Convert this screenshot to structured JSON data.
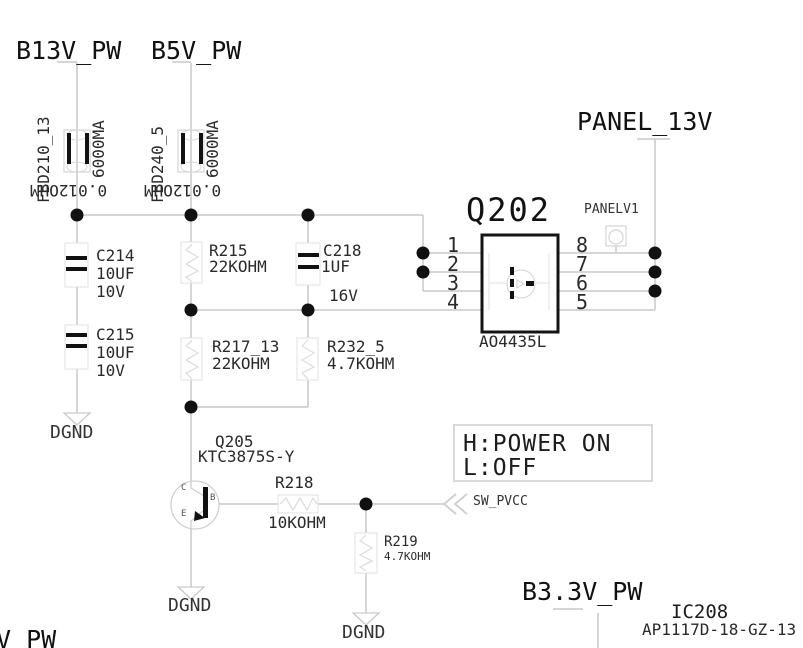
{
  "colors": {
    "wire": "#c9c9c9",
    "outline": "#dcdcdc",
    "ink": "#1a1a1a"
  },
  "power_rails": {
    "b13v": "B13V_PW",
    "b5v": "B5V_PW",
    "panel_13v": "PANEL_13V",
    "b3_3v": "B3.3V_PW",
    "partial_rail": "V_PW"
  },
  "grounds": {
    "dgnd": "DGND"
  },
  "signals": {
    "sw_pvcc": "SW_PVCC"
  },
  "note": {
    "line1": "H:POWER ON",
    "line2": "L:OFF"
  },
  "components": {
    "fbd210": {
      "ref": "FBD210_13",
      "rating": "6000MA",
      "value": "0.012OHM"
    },
    "fbd240": {
      "ref": "FBD240_5",
      "rating": "6000MA",
      "value": "0.012OHM"
    },
    "c214": {
      "ref": "C214",
      "value": "10UF",
      "rating": "10V"
    },
    "c215": {
      "ref": "C215",
      "value": "10UF",
      "rating": "10V"
    },
    "c218": {
      "ref": "C218",
      "value": "1UF",
      "rating": "16V"
    },
    "r215": {
      "ref": "R215",
      "value": "22KOHM"
    },
    "r217": {
      "ref": "R217_13",
      "value": "22KOHM"
    },
    "r232": {
      "ref": "R232_5",
      "value": "4.7KOHM"
    },
    "r218": {
      "ref": "R218",
      "value": "10KOHM"
    },
    "r219": {
      "ref": "R219",
      "value": "4.7KOHM"
    },
    "q202": {
      "ref": "Q202",
      "part": "AO4435L",
      "pins_left": [
        "1",
        "2",
        "3",
        "4"
      ],
      "pins_right": [
        "8",
        "7",
        "6",
        "5"
      ]
    },
    "q205": {
      "ref": "Q205",
      "part": "KTC3875S-Y",
      "pin_c": "C",
      "pin_b": "B",
      "pin_e": "E"
    },
    "tp_panelv1": {
      "ref": "PANELV1"
    },
    "ic208": {
      "ref": "IC208",
      "part": "AP1117D-18-GZ-13"
    }
  }
}
